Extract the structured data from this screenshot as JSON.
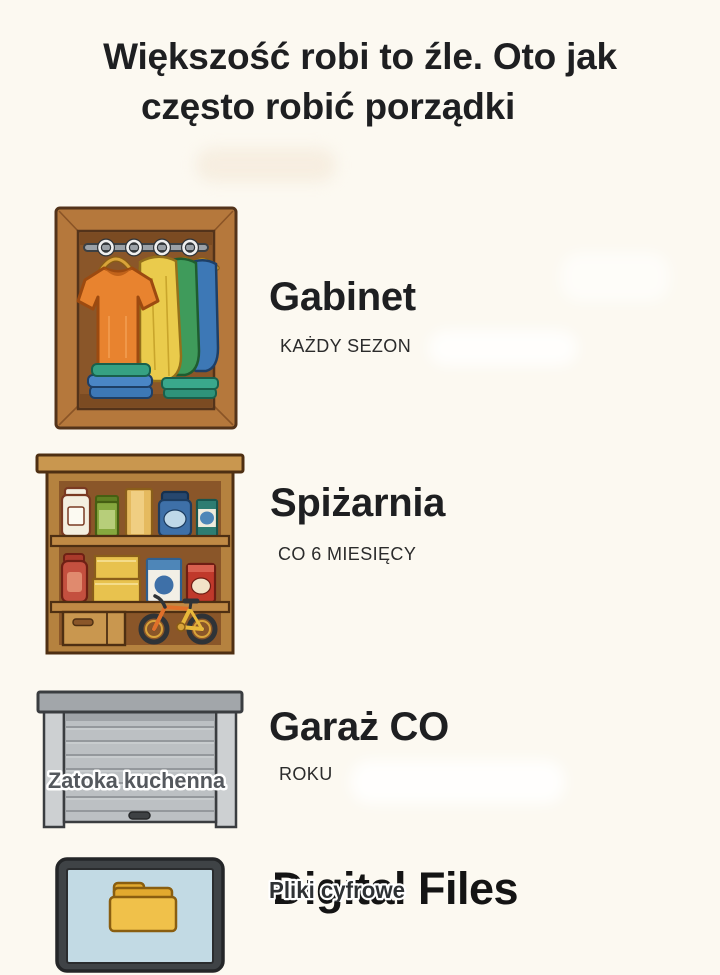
{
  "page": {
    "background_color": "#FCF9F1",
    "title_line1": "Większość robi to źle. Oto jak",
    "title_line2": "często robić porządki"
  },
  "rows": [
    {
      "name": "closet",
      "illustration": "wardrobe-with-hanging-shirts-icon",
      "heading": "Gabinet",
      "frequency": "KAŻDY SEZON"
    },
    {
      "name": "pantry",
      "illustration": "pantry-shelf-with-jars-box-and-bicycle-icon",
      "heading": "Spiżarnia",
      "frequency": "CO 6 MIESIĘCY"
    },
    {
      "name": "garage",
      "illustration": "garage-roller-door-icon",
      "overlay_label": "Zatoka kuchenna",
      "heading": "Garaż CO",
      "frequency": "ROKU"
    },
    {
      "name": "digital-files",
      "illustration": "computer-monitor-with-folder-icon",
      "heading_base": "Digital Files",
      "heading_overlay": "Pliki cyfrowe"
    }
  ],
  "palette": {
    "background": "#FCF9F1",
    "text_primary": "#1E1F21",
    "text_secondary": "#2B2B2B",
    "wardrobe_wood": "#B5783C",
    "wardrobe_interior": "#8A5629",
    "shirt_orange": "#E8832F",
    "shirt_yellow": "#EACB4C",
    "shirt_green": "#3F9B5B",
    "shirt_blue": "#3D78B6",
    "folded_teal": "#36A183",
    "pantry_wood": "#B5823F",
    "garage_gray": "#BCC0C3",
    "garage_label_gray": "#54585D",
    "monitor_bezel": "#3F4346",
    "screen_blue": "#C2DAE4",
    "folder_yellow": "#F0C14A"
  }
}
